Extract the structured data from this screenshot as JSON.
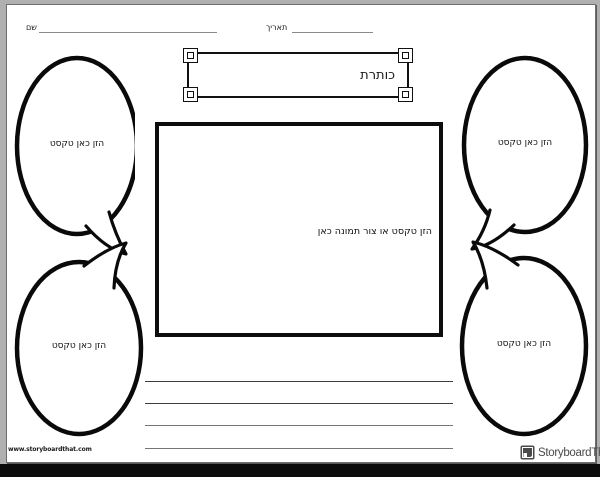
{
  "header": {
    "name_label": "שם",
    "date_label": "תאריך"
  },
  "title_banner": {
    "text": "כותרת"
  },
  "image_box": {
    "placeholder": "הזן טקסט או צור תמונה כאן"
  },
  "bubbles": {
    "top_left": {
      "text": "הזן כאן טקסט"
    },
    "top_right": {
      "text": "הזן כאן טקסט"
    },
    "bottom_left": {
      "text": "הזן כאן טקסט"
    },
    "bottom_right": {
      "text": "הזן כאן טקסט"
    }
  },
  "writing_lines": {
    "count": 4
  },
  "footer": {
    "website": "www.storyboardthat.com",
    "brand": "StoryboardThat"
  },
  "colors": {
    "ink": "#000000",
    "rule_line": "#8a8a8a",
    "writing_line_dark": "#3d3d3d",
    "writing_line_light": "#757575",
    "brand_text": "#4a4a4a",
    "page_background": "#ffffff",
    "surround_background": "#b0b0b0",
    "bottom_bar": "#000000"
  }
}
